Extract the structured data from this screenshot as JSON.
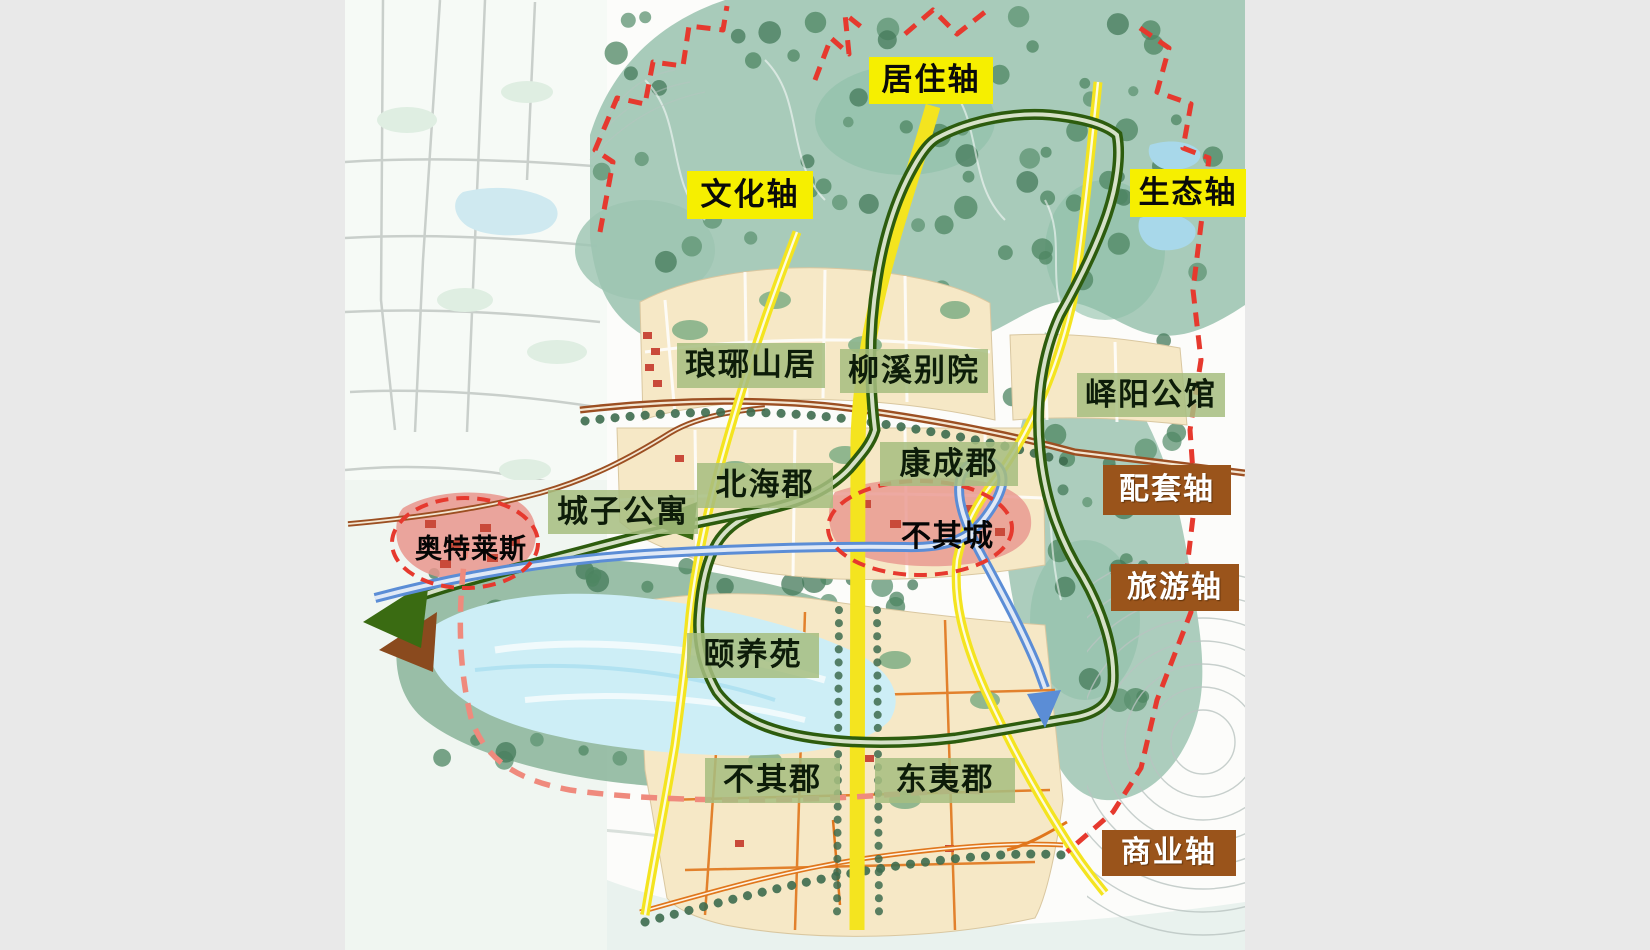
{
  "axis_labels": {
    "residential": "居住轴",
    "culture": "文化轴",
    "ecology": "生态轴",
    "supporting": "配套轴",
    "tourism": "旅游轴",
    "commerce": "商业轴"
  },
  "district_labels": {
    "langya_shanju": "琅琊山居",
    "liuxi_bieyuan": "柳溪别院",
    "yiyang_gongguan": "峄阳公馆",
    "beihai_jun": "北海郡",
    "kangcheng_jun": "康成郡",
    "chengzi_gongyu": "城子公寓",
    "yiyang_yuan": "颐养苑",
    "buqi_jun": "不其郡",
    "dongyi_jun": "东夷郡"
  },
  "zone_labels": {
    "outlets": "奥特莱斯",
    "buqi_cheng": "不其城"
  },
  "colors": {
    "axis_label_yellow": "#f6ef00",
    "axis_label_brown": "#9a541b",
    "district_label_green": "#a6be80",
    "road_axis_yellow": "#f4e41f",
    "ring_road_green": "#2d5c0e",
    "tourism_route_blue": "#5b8dd6",
    "road_orange": "#e0761c",
    "road_brown": "#9c4f22",
    "boundary_red": "#e6392e",
    "boundary_pink": "#ef8a7d",
    "forest_teal": "#a3c8b6",
    "block_beige": "#f6e8c6",
    "lake_blue": "#cdeef6",
    "zone_pink": "#e9958d",
    "page_margin_gray": "#e9e9e9"
  }
}
